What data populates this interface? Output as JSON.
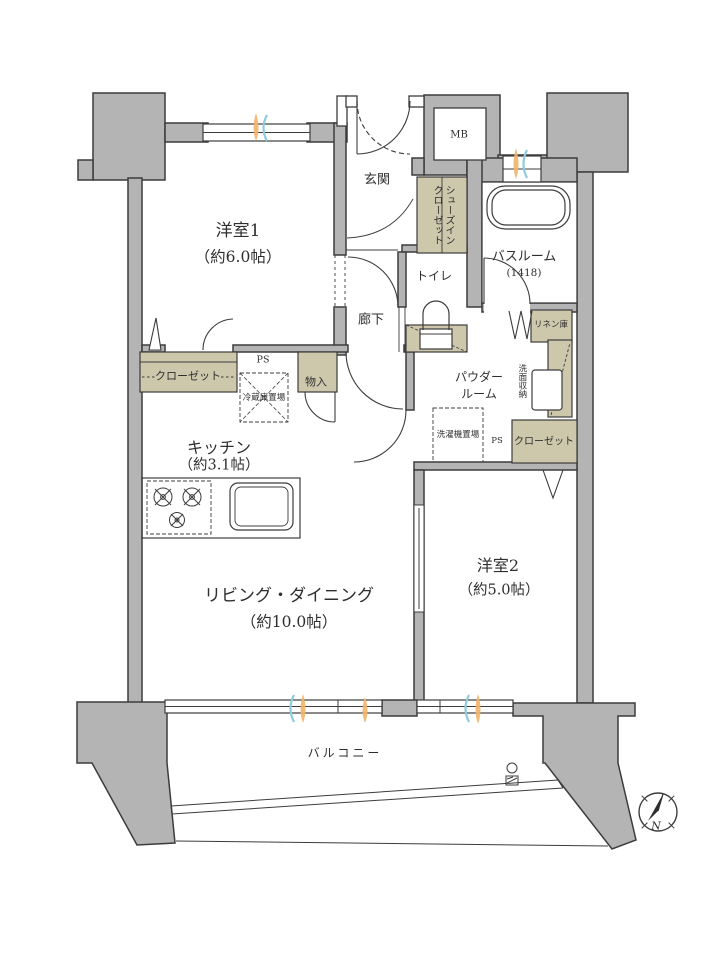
{
  "rooms": {
    "bedroom1": {
      "name": "洋室1",
      "size": "（約6.0帖）"
    },
    "bedroom2": {
      "name": "洋室2",
      "size": "（約5.0帖）"
    },
    "living_dining": {
      "name": "リビング・ダイニング",
      "size": "（約10.0帖）"
    },
    "kitchen": {
      "name": "キッチン",
      "size": "（約3.1帖）"
    },
    "entrance": {
      "name": "玄関"
    },
    "hallway": {
      "name": "廊下"
    },
    "toilet": {
      "name": "トイレ"
    },
    "bathroom": {
      "name": "バスルーム",
      "size": "(1418)"
    },
    "powder_room": {
      "name_line1": "パウダー",
      "name_line2": "ルーム"
    },
    "balcony": {
      "name": "バルコニー"
    }
  },
  "storage": {
    "closet_bedroom1": "クローゼット",
    "closet_bedroom2": "クローゼット",
    "shoes_closet_line1": "シューズイン",
    "shoes_closet_line2": "クローゼット",
    "linen": "リネン庫",
    "washstand_storage": "洗面収納",
    "cabinet": "物入"
  },
  "utility": {
    "meter_box": "MB",
    "pipe_space": "PS",
    "refrigerator_space": "冷蔵庫置場",
    "washer_space": "洗濯機置場"
  },
  "compass": {
    "north_label": "N"
  },
  "colors": {
    "wall": "#b4b4b4",
    "outline": "#3c3c3c",
    "storage_fill": "#cdc7ac",
    "vent_orange": "#f2b469",
    "vent_blue": "#8fcbdb"
  }
}
